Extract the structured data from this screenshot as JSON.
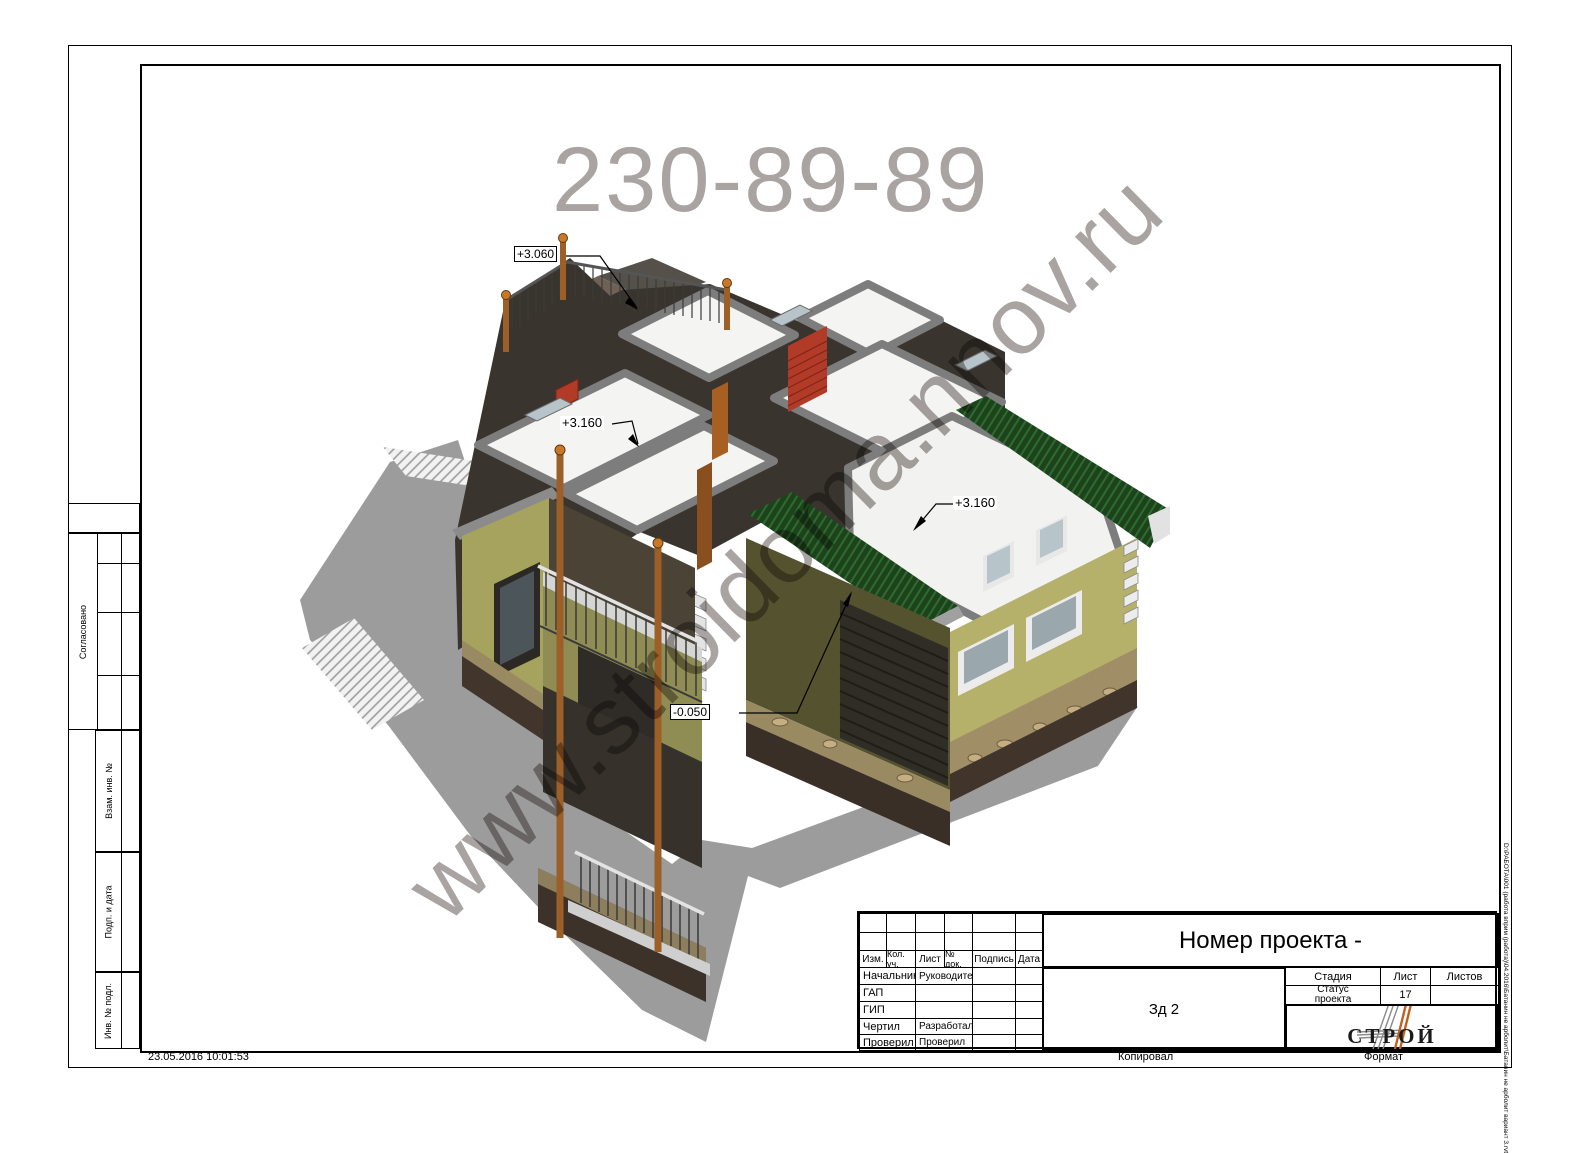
{
  "sheet": {
    "timestamp": "23.05.2016 10:01:53",
    "copied_label": "Копировал",
    "format_label": "Формат",
    "file_path": "D:\\РАБОТА\\001 (работа вприм (работа)\\04.2016\\Батанин не арболит\\Батанин не арболит вариант 3.rvt"
  },
  "watermarks": {
    "phone": "230-89-89",
    "site": "www.stroidoma.nnov.ru"
  },
  "annotations": {
    "terrace_level": "+3.060",
    "left_room_level": "+3.160",
    "garage_level": "+3.160",
    "ground_level": "-0.050"
  },
  "left_margin": {
    "agreed_label": "Согласовано",
    "interchange_inv_label": "Взам. инв. №",
    "sign_date_label": "Подп. и дата",
    "inv_original_label": "Инв. № подл."
  },
  "title_block": {
    "project_title": "Номер проекта -",
    "sheet_name": "Зд 2",
    "header_cols": [
      "Изм.",
      "Кол. уч.",
      "Лист",
      "№ док.",
      "Подпись",
      "Дата"
    ],
    "rows": [
      {
        "left": "Начальник",
        "right": "Руководитель"
      },
      {
        "left": "ГАП",
        "right": ""
      },
      {
        "left": "ГИП",
        "right": ""
      },
      {
        "left": "Чертил",
        "right": "Разработал"
      },
      {
        "left": "Проверил",
        "right": "Проверил"
      }
    ],
    "stage_label": "Стадия",
    "sheet_label": "Лист",
    "sheets_label": "Листов",
    "stage_value_line1": "Статус",
    "stage_value_line2": "проекта",
    "sheet_number": "17",
    "sheets_total": "",
    "logo_text": "СТРОЙ"
  },
  "colors": {
    "wall_olive": "#a6a35f",
    "wall_dark_front": "#55522f",
    "wall_yellow": "#b5b06a",
    "roof_green": "#1d431d",
    "basement_brown": "#3a2f27",
    "stone_band": "#9a8a62",
    "brick_red": "#b23b28",
    "watermark_gray": "#a9a4a2",
    "shadow_gray": "#9c9c9c"
  }
}
